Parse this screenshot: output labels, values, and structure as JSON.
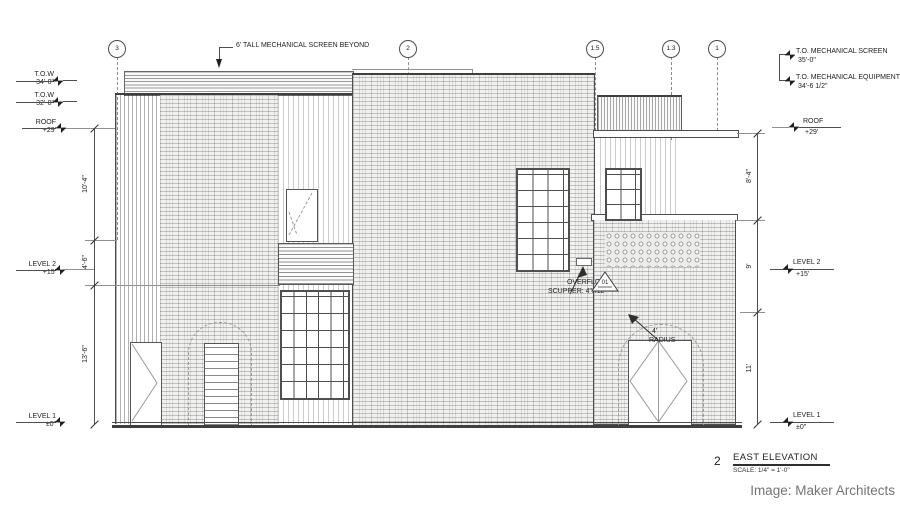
{
  "colors": {
    "line": "#4d4d4d",
    "hatch_gray": "#c9c9c9",
    "background": "#ffffff",
    "credit_text": "#757575"
  },
  "grid": {
    "bubbles": [
      {
        "label": "3"
      },
      {
        "label": "2"
      },
      {
        "label": "1.5"
      },
      {
        "label": "1.3"
      },
      {
        "label": "1"
      }
    ]
  },
  "levels": {
    "left": [
      {
        "name": "T.O.W",
        "elev": "34'-0\""
      },
      {
        "name": "T.O.W",
        "elev": "32'-0\""
      },
      {
        "name": "ROOF",
        "elev": "+29'"
      },
      {
        "name": "LEVEL 2",
        "elev": "+15'"
      },
      {
        "name": "LEVEL 1",
        "elev": "±0\""
      }
    ],
    "right": [
      {
        "name": "T.O. MECHANICAL SCREEN",
        "elev": "35'-0\""
      },
      {
        "name": "T.O. MECHANICAL EQUIPMENT",
        "elev": "34'-6 1/2\""
      },
      {
        "name": "ROOF",
        "elev": "+29'"
      },
      {
        "name": "LEVEL 2",
        "elev": "+15'"
      },
      {
        "name": "LEVEL 1",
        "elev": "±0\""
      }
    ]
  },
  "dims": {
    "left": [
      "10'-4\"",
      "4'-6\"",
      "13'-6\""
    ],
    "right": [
      "8'-4\"",
      "9'",
      "11'"
    ]
  },
  "annotations": {
    "mech_screen": "6' TALL MECHANICAL SCREEN BEYOND",
    "overflow_line1": "OVERFLOW",
    "overflow_line2": "SCUPPER: 4\"X12\"",
    "detail_marker": "01",
    "radius_value": "4'",
    "radius_label": "RADIUS"
  },
  "title_block": {
    "number": "2",
    "title": "EAST ELEVATION",
    "scale": "SCALE: 1/4\"  =   1'-0\""
  },
  "credit": "Image: Maker Architects"
}
